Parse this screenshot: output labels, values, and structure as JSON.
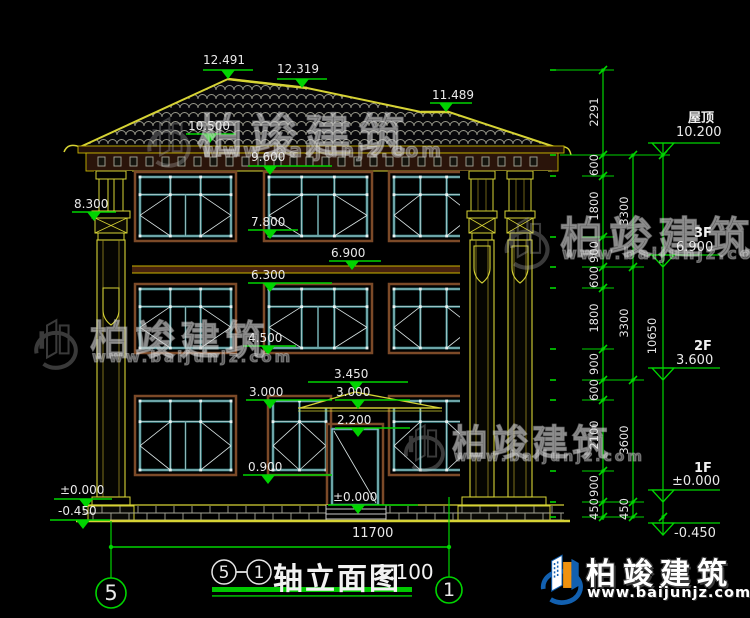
{
  "brand": {
    "name": "柏竣建筑",
    "url": "www.baijunjz.com"
  },
  "drawing_title": {
    "axis_from": "5",
    "separator": "—",
    "axis_to": "1",
    "name": "轴立面图",
    "scale": "1:100"
  },
  "bottom_dimension": "11700",
  "axis_bubbles": {
    "left": "5",
    "right": "1"
  },
  "floor_levels": [
    {
      "floor": "屋顶",
      "elevation": "10.200"
    },
    {
      "floor": "3F",
      "elevation": "6.900"
    },
    {
      "floor": "2F",
      "elevation": "3.600"
    },
    {
      "floor": "1F",
      "elevation": "±0.000"
    },
    {
      "floor": "",
      "elevation": "-0.450"
    }
  ],
  "spot_elevations": [
    "12.491",
    "12.319",
    "11.489",
    "10.500",
    "9.600",
    "8.300",
    "7.800",
    "6.900",
    "6.300",
    "4.500",
    "3.450",
    "3.000",
    "3.000",
    "2.200",
    "0.900",
    "±0.000",
    "±0.000",
    "-0.450"
  ],
  "dim_chains": {
    "inner": [
      "2291",
      "600",
      "1800",
      "900",
      "600",
      "1800",
      "900",
      "600",
      "2100",
      "900",
      "450"
    ],
    "middle": [
      "3300",
      "3300",
      "3600",
      "450"
    ],
    "outer": [
      "10650"
    ]
  },
  "colors": {
    "dim_green": "#00d400",
    "cad_yellow": "#d6d335",
    "window_teal": "#3e8a8e",
    "frame_brown": "#7c4a28",
    "logo_blue": "#1260b0",
    "logo_orange": "#f0920e"
  }
}
